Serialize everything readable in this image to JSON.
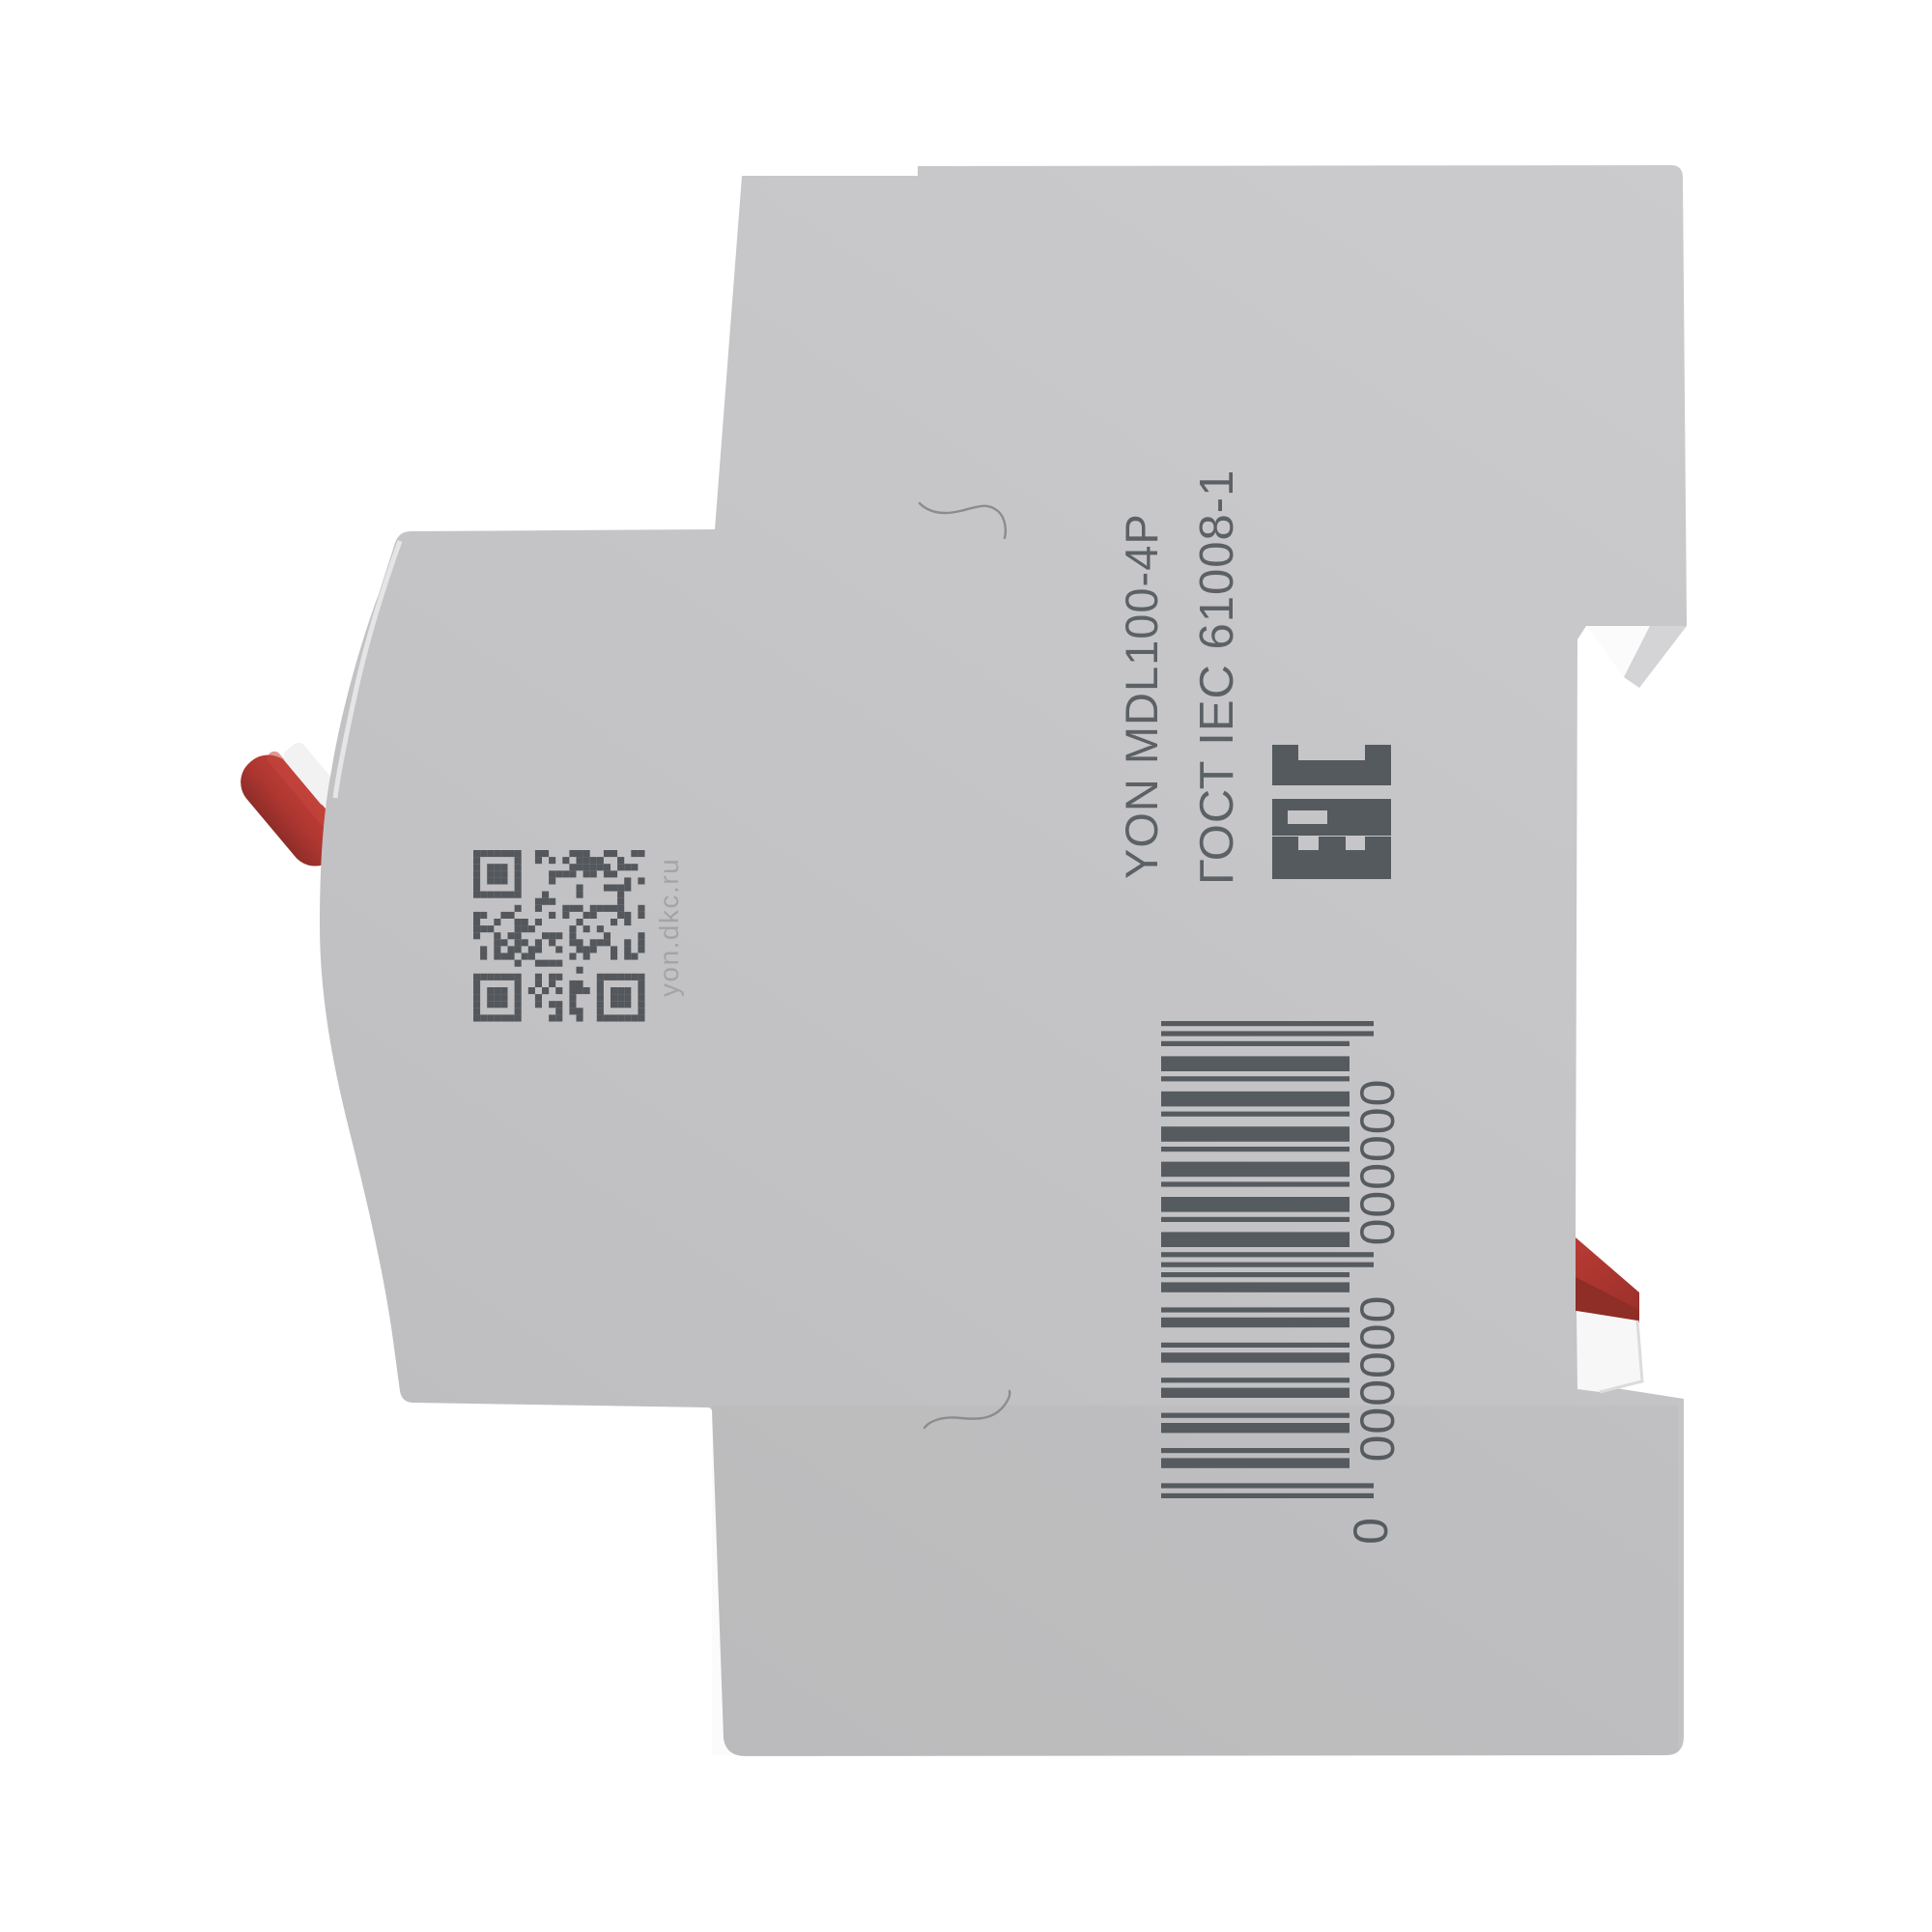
{
  "product": {
    "model_line": "YON  MDL100-4P",
    "standard_line": "ГОСТ IEC 61008-1",
    "eac_label": "EAC",
    "qr_caption": "yon.dkc.ru",
    "barcode": {
      "lead_digit": "0",
      "group1": "000000",
      "group2": "000000"
    }
  },
  "colors": {
    "background": "#ffffff",
    "body_gray": "#c5c5c7",
    "body_gray_light": "#cbcbcd",
    "body_gray_dark": "#bdbdbf",
    "print_dark": "#5a5f63",
    "print_light": "#a4a4a6",
    "accent_red": "#b23a33",
    "accent_red_dark": "#8f2d27",
    "white_part": "#f7f7f8"
  }
}
